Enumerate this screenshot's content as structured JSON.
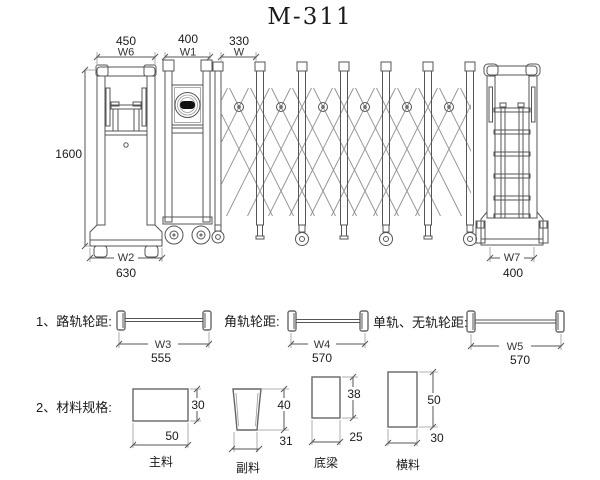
{
  "title": "M-311",
  "elevation": {
    "head_width": "450",
    "head_width_label": "W6",
    "unit_width": "400",
    "unit_width_label": "W1",
    "module_width": "330",
    "module_width_label": "W",
    "height": "1600",
    "head_base_label": "W2",
    "head_base": "630",
    "tail_width_label": "W7",
    "tail_width": "400"
  },
  "wheel_spacing": {
    "items": [
      {
        "heading": "1、路轨轮距:",
        "dim_label": "W3",
        "value": "555"
      },
      {
        "heading": "角轨轮距:",
        "dim_label": "W4",
        "value": "570"
      },
      {
        "heading": "单轨、无轨轮距:",
        "dim_label": "W5",
        "value": "570"
      }
    ]
  },
  "materials": {
    "heading": "2、材料规格:",
    "items": [
      {
        "name": "主料",
        "width": "50",
        "height": "30"
      },
      {
        "name": "副料",
        "width": "31",
        "height": "40"
      },
      {
        "name": "底梁",
        "width": "25",
        "height": "38"
      },
      {
        "name": "横料",
        "width": "30",
        "height": "50"
      }
    ]
  }
}
